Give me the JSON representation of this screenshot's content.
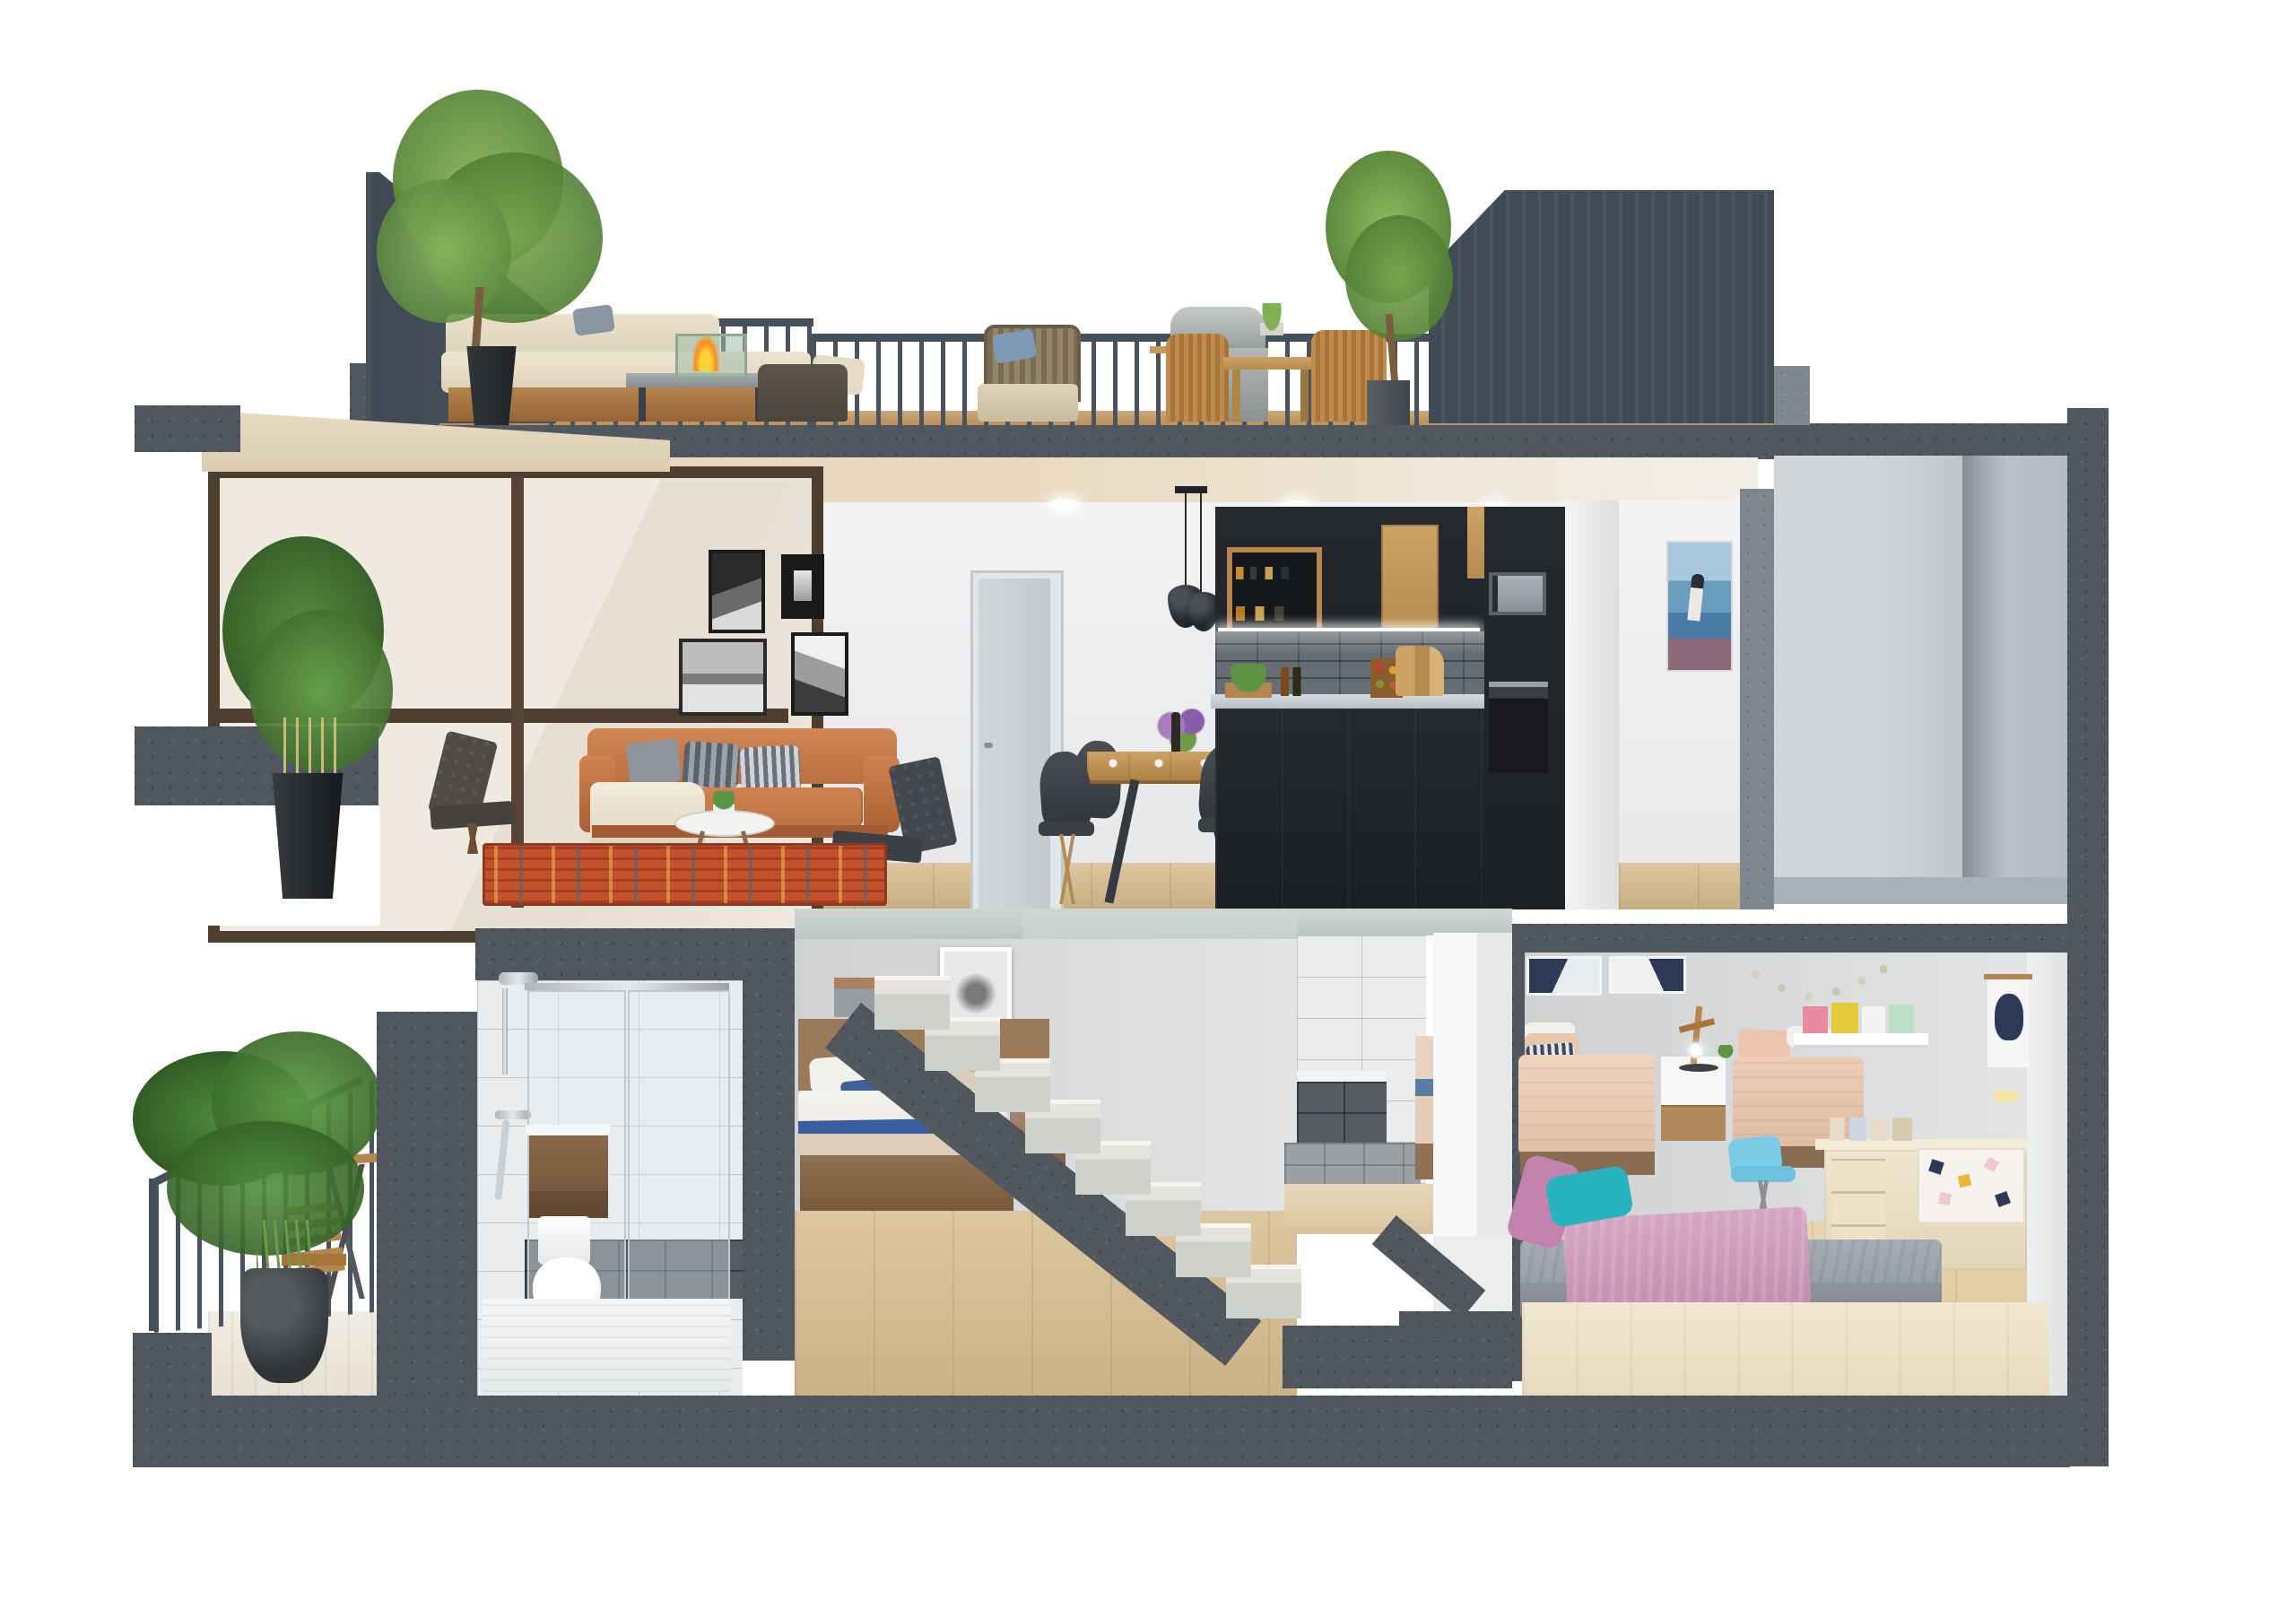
{
  "scene": {
    "description": "3D cutaway cross-section render of a two-storey apartment with roof terrace",
    "floors": [
      {
        "name": "roof-terrace",
        "objects": [
          "slate-metal-railing",
          "olive-tree-left",
          "black-planter",
          "outdoor-corner-sofa",
          "fire-pit-table",
          "dark-lounge-armchair",
          "rattan-armchair",
          "barbecue-grill",
          "wooden-dining-table",
          "rattan-dining-chairs",
          "table-plant",
          "olive-tree-right",
          "concrete-parapet"
        ]
      },
      {
        "name": "main-floor",
        "rooms": [
          {
            "name": "living-room",
            "objects": [
              "corner-window",
              "bamboo-plant",
              "black-planter",
              "gallery-wall-4-bw-prints",
              "orange-leather-sofa",
              "throw-blanket",
              "striped-pillows",
              "round-coffee-table",
              "small-plant",
              "two-dark-lounge-chairs",
              "persian-rug",
              "interior-door",
              "recessed-ceiling-lights"
            ]
          },
          {
            "name": "dining-area",
            "objects": [
              "wood-dining-table",
              "black-shell-chairs",
              "flower-centerpiece",
              "place-settings",
              "black-pendant-lamps"
            ]
          },
          {
            "name": "kitchen",
            "objects": [
              "black-cabinets",
              "wood-cabinet-fronts",
              "open-shelf-with-jars",
              "led-strip",
              "brick-backsplash",
              "stone-countertop",
              "basil-crate",
              "oil-bottles",
              "spice-rack",
              "cutting-boards",
              "built-in-microwave",
              "built-in-oven",
              "white-pillar"
            ]
          },
          {
            "name": "hallway",
            "objects": [
              "seaside-painting"
            ]
          },
          {
            "name": "utility-shaft",
            "objects": [
              "concrete-frame",
              "empty-gray-room"
            ]
          }
        ]
      },
      {
        "name": "lower-floor",
        "rooms": [
          {
            "name": "balcony",
            "objects": [
              "sloped-railing",
              "areca-palm",
              "clay-pot",
              "folding-bistro-table",
              "folding-chair",
              "white-deck-floor"
            ]
          },
          {
            "name": "bathroom",
            "objects": [
              "shower-fixture",
              "glass-screen",
              "wood-vanity",
              "white-basin",
              "toilet",
              "dark-tile-floor",
              "white-shower-tray"
            ]
          },
          {
            "name": "master-bedroom",
            "objects": [
              "framed-print",
              "wood-headboard-bed",
              "blue-accent-pillows",
              "nightstand",
              "cutaway-concrete-staircase",
              "wood-floor"
            ]
          },
          {
            "name": "second-bathroom",
            "objects": [
              "white-tiles",
              "dark-tiled-tub",
              "gray-tile-floor",
              "white-partition"
            ]
          },
          {
            "name": "kids-bedroom",
            "objects": [
              "two-navy-prints",
              "two-single-beds-peach",
              "white-nightstand",
              "wood-desk-lamp",
              "star-garland",
              "book-ledge-with-books",
              "hanging-poster",
              "cream-desk",
              "patterned-storage-box",
              "house-figurines",
              "blue-chair",
              "platform-bed-gray-duvet",
              "pink-blanket",
              "teal-pillow",
              "pink-pillow",
              "cream-bed-base"
            ]
          }
        ]
      },
      {
        "name": "foundation",
        "objects": [
          "concrete-base-slab",
          "stepped-left-block"
        ]
      }
    ],
    "palette": {
      "background": "#ffffff",
      "concrete_dark": "#51575e",
      "concrete_light": "#7f868d",
      "slab_cut_pale": "#cfd7d4",
      "railing_slate": "#46505a",
      "wall_white": "#f3f3f4",
      "wall_gray": "#d4d6d8",
      "ceiling_cream": "#e9d9c0",
      "wood_floor": "#d4ba8e",
      "terrace_wood": "#c19a6b",
      "sofa_orange": "#c87c4a",
      "rug_orange": "#c4512c",
      "kitchen_black": "#23272b",
      "cabinet_wood": "#c49c5e",
      "counter_gray": "#c6ccd0",
      "foliage_green": "#5f9447",
      "bed_wood": "#9a7a58",
      "accent_blue": "#3a5fa0",
      "kids_peach": "#edcdb8",
      "kids_pink": "#d2a0bf",
      "kids_teal": "#27b3bf",
      "kids_cream": "#f0e6cf",
      "chair_blue": "#7ccce8",
      "flame_orange": "#ff8c1a",
      "chrome": "#c9d0d6"
    }
  }
}
